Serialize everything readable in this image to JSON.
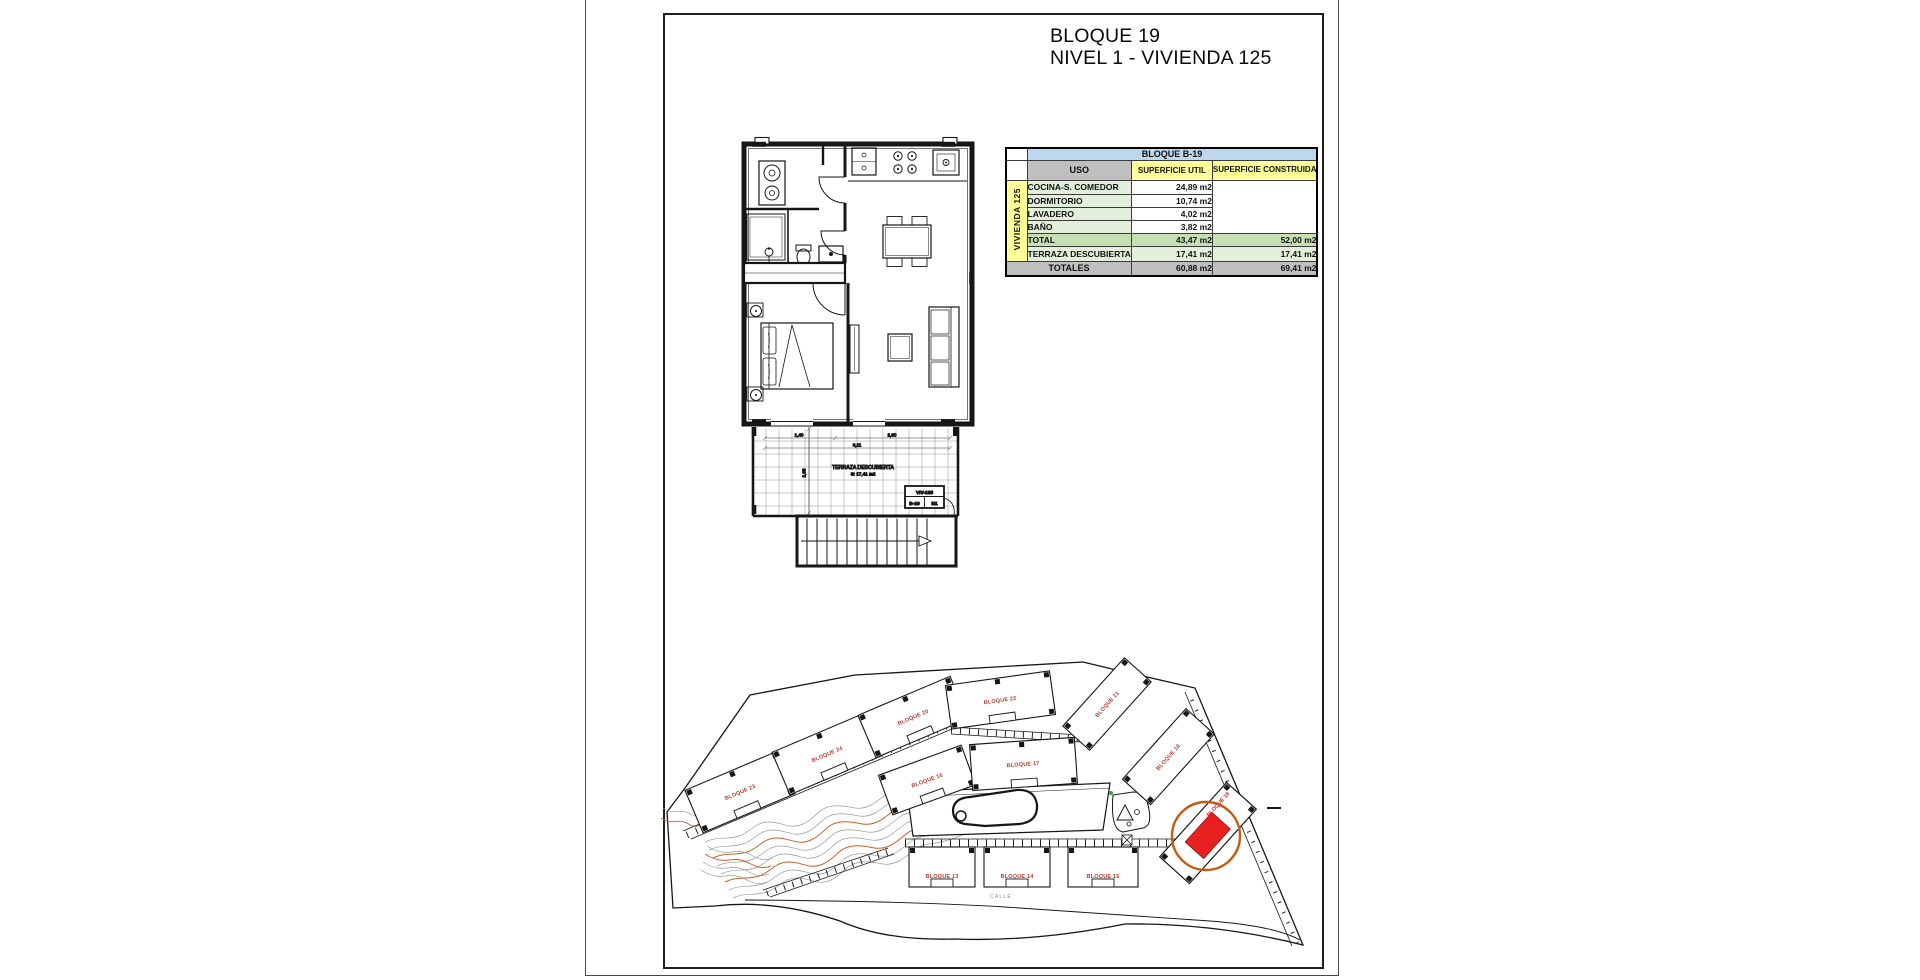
{
  "title": {
    "line1": "BLOQUE 19",
    "line2": "NIVEL 1 - VIVIENDA 125"
  },
  "area_table": {
    "header": "BLOQUE B-19",
    "columns": {
      "uso": "USO",
      "util": "SUPERFICIE UTIL",
      "construida": "SUPERFICIE CONSTRUIDA"
    },
    "unit_label": "VIVIENDA 125",
    "rooms": [
      {
        "name": "COCINA-S. COMEDOR",
        "util": "24,89 m2"
      },
      {
        "name": "DORMITORIO",
        "util": "10,74 m2"
      },
      {
        "name": "LAVADERO",
        "util": "4,02 m2"
      },
      {
        "name": "BAÑO",
        "util": "3,82 m2"
      }
    ],
    "total_row": {
      "name": "TOTAL",
      "util": "43,47 m2",
      "construida": "52,00 m2"
    },
    "terrace_row": {
      "name": "TERRAZA DESCUBIERTA",
      "util": "17,41 m2",
      "construida": "17,41 m2"
    },
    "totals_row": {
      "name": "TOTALES",
      "util": "60,88 m2",
      "construida": "69,41 m2"
    },
    "colors": {
      "header_blue": "#bdd7ee",
      "gray": "#bfbfbf",
      "yellow": "#ffff99",
      "light_green": "#e2efda",
      "green": "#c6e0b4"
    }
  },
  "floor_plan": {
    "terrace_label": "TERRAZA DESCUBIERTA",
    "terrace_area": "S: 17,41 m2",
    "unit_tag": {
      "line1": "VIV-125",
      "block": "B-19",
      "level": "N1"
    },
    "dimensions": {
      "left": "1,40",
      "right": "2,80",
      "total": "6,11",
      "depth": "2,85"
    }
  },
  "site_plan": {
    "street_label": "CALLE",
    "highlight": {
      "label": "BLOQUE 19",
      "fill": "#e8201f",
      "ring": "#c55a11"
    },
    "label_color": "#b23b2e",
    "contour_colors": {
      "minor": "#9a9a9a",
      "major": "#c4622d"
    },
    "blocks": [
      {
        "label": "BLOQUE 23"
      },
      {
        "label": "BLOQUE 24"
      },
      {
        "label": "BLOQUE 20"
      },
      {
        "label": "BLOQUE 22"
      },
      {
        "label": "BLOQUE 21"
      },
      {
        "label": "BLOQUE 16"
      },
      {
        "label": "BLOQUE 17"
      },
      {
        "label": "BLOQUE 18"
      },
      {
        "label": "BLOQUE 13"
      },
      {
        "label": "BLOQUE 14"
      },
      {
        "label": "BLOQUE 15"
      }
    ]
  }
}
